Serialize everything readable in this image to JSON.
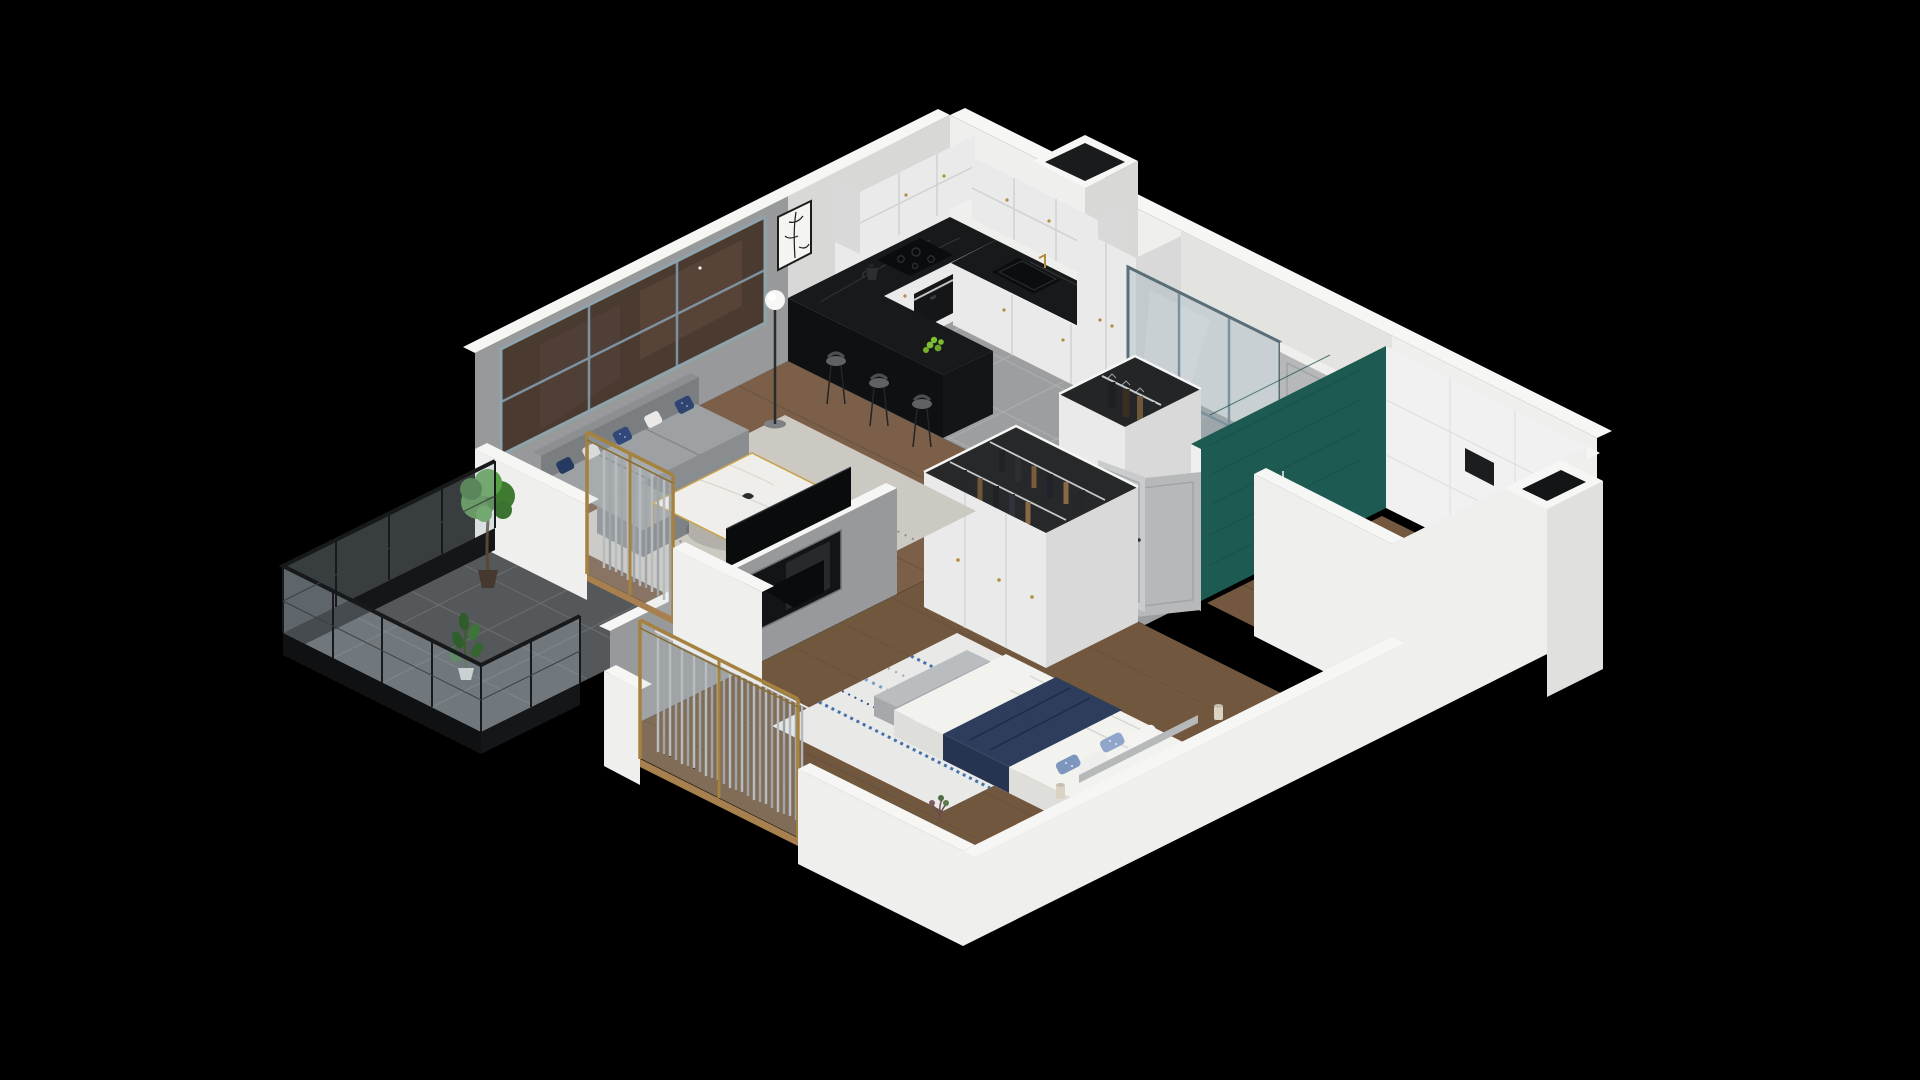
{
  "meta": {
    "title": "3D isometric apartment floor plan render",
    "description": "Cutaway dollhouse view of a one-bedroom apartment with living room, kitchen, entry hall, bathroom, wardrobe, bedroom and balcony on a black background"
  },
  "palette": {
    "bg": "#000000",
    "wallWhite": "#efefed",
    "wallWhiteLit": "#f6f6f4",
    "wallShade": "#d8d8d6",
    "wallGray": "#98999b",
    "wallGrayDeep": "#8e8f91",
    "tile": "#9c9ea0",
    "tileGrout": "#b2b4b5",
    "woodLiving": "#7b5f49",
    "woodPlank": "#67503c",
    "woodBedroom": "#72573f",
    "woodBath": "#74573f",
    "balconyTile": "#55585a",
    "balconyGrout": "#6b6e70",
    "counter": "#17191b",
    "counterFace": "#0e1012",
    "counterVein": "#3a3e42",
    "cabinet": "#e9eae9",
    "cabinetShade": "#d8d9d8",
    "gold": "#b08d3f",
    "goldFrame": "#a5823f",
    "teal": "#1d5b52",
    "tealDark": "#174c45",
    "tileWhite": "#f0f1f0",
    "glassTint": "#aebfc8",
    "frameSteel": "#7c939f",
    "doorGray": "#b7b8b9",
    "sofa": "#9ea1a4",
    "sofaDark": "#8a8d90",
    "sofaBack": "#7b7e81",
    "rugLiving": "#ccc9c2",
    "rugSpeckle": "#918e88",
    "rugBedroom": "#e9eae8",
    "rugBlue": "#4272aa",
    "duvet": "#f2f2ef",
    "duvetShade": "#dededa",
    "navy": "#2e3d5c",
    "navyDark": "#263450",
    "floral": "#8fa5c9",
    "curtain": "#b3b6b9",
    "curtainShade": "#989b9e",
    "plant": "#3f7a31",
    "plantDark": "#2e5f2a",
    "plantLight": "#57a048",
    "potBrown": "#46382f",
    "railing": "#17191b",
    "tvBlack": "#0a0b0c",
    "nicheBlack": "#121416",
    "marbleTable": "#efeeea",
    "lampCream": "#ddd3c4",
    "bench": "#babdbf",
    "headboard": "#b6b8ba",
    "toiletWhite": "#fafaf8",
    "woodThreshold": "#a87f4e",
    "ovenBlack": "#141617",
    "apples": "#7fbe33"
  },
  "scene": {
    "style": "isometric-cutaway",
    "rooms": [
      {
        "id": "living-room",
        "furniture": [
          "sofa",
          "pillows",
          "coffee-table",
          "floor-lamp",
          "area-rug",
          "wall-art",
          "panorama-window",
          "fern-plant"
        ]
      },
      {
        "id": "kitchen",
        "furniture": [
          "upper-cabinets",
          "base-cabinets",
          "black-marble-counter",
          "induction-cooktop",
          "oven",
          "sink",
          "kettle",
          "peninsula-bar",
          "bar-stools",
          "green-apples",
          "tall-cabinet"
        ]
      },
      {
        "id": "entry-hall",
        "furniture": [
          "glazed-partition",
          "entry-door",
          "coat-rack"
        ]
      },
      {
        "id": "bathroom",
        "furniture": [
          "teal-tile-wall",
          "wall-hung-toilet",
          "flush-plate",
          "toilet-paper-holder",
          "shower-screen",
          "vanity",
          "open-door"
        ]
      },
      {
        "id": "wardrobe",
        "furniture": [
          "open-top-wardrobe",
          "clothes-rails",
          "hanging-clothes"
        ]
      },
      {
        "id": "bedroom",
        "furniture": [
          "double-bed",
          "navy-throw",
          "floral-pillows",
          "bench",
          "nightstands",
          "table-lamps",
          "blue-rug",
          "curtains",
          "gold-frame-window",
          "radiator",
          "door-leaf"
        ]
      },
      {
        "id": "balcony",
        "furniture": [
          "glass-railing",
          "potted-tree",
          "rubber-plant",
          "dark-tiles",
          "sliding-door"
        ]
      }
    ]
  }
}
